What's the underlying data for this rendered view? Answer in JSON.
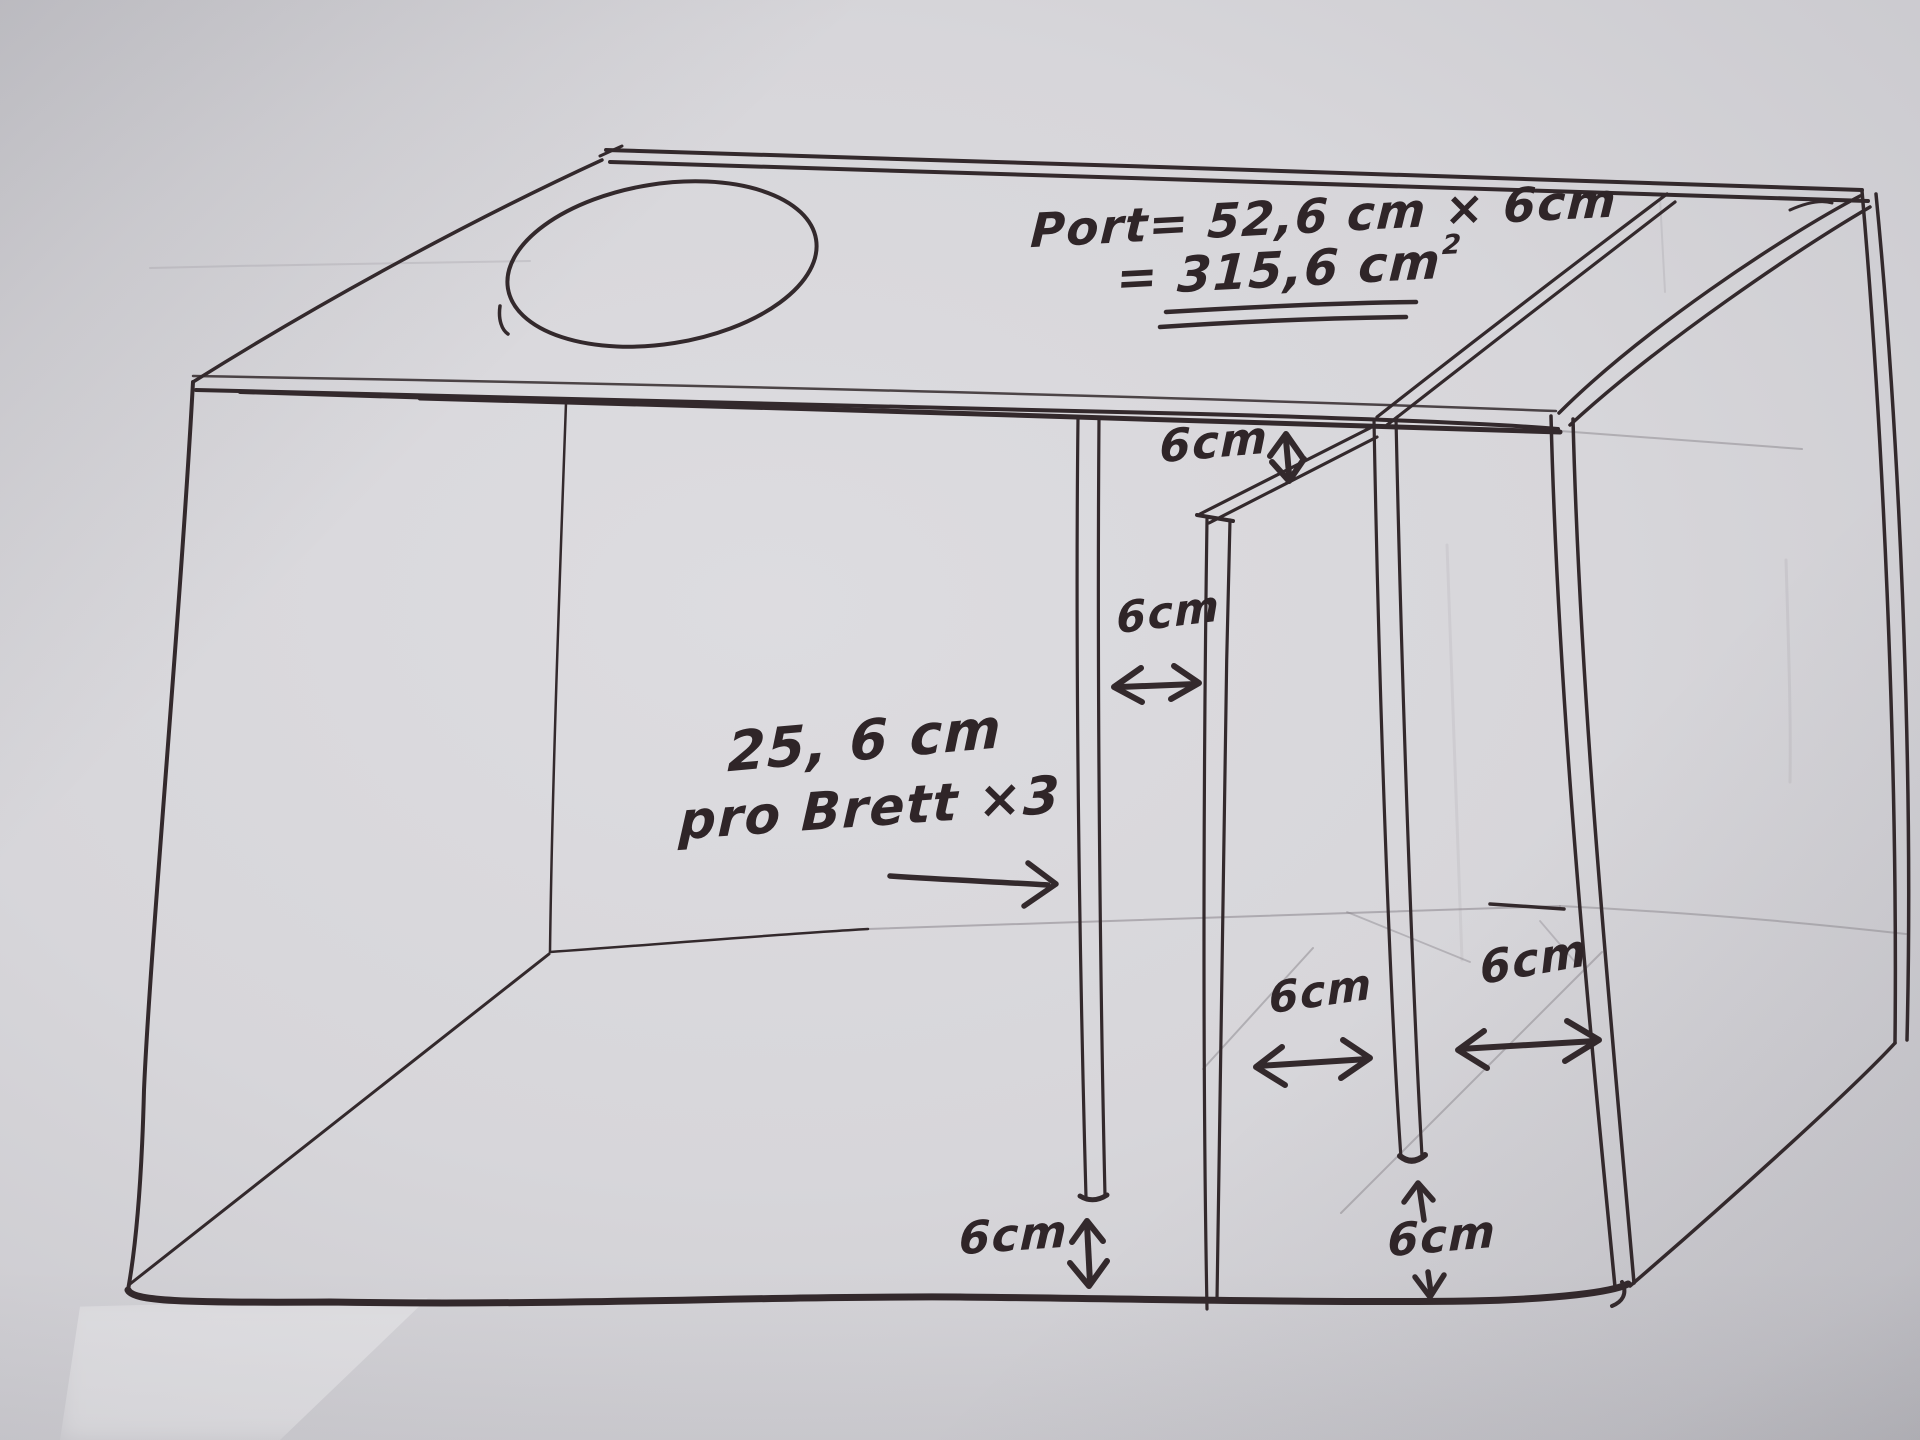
{
  "title": "Hand-drawn loudspeaker box sketch with port dimensions",
  "paper": {
    "background": "#d7d6da",
    "ink": "#33292c",
    "pencil": "#8a858c",
    "text_ink": "#2f2528"
  },
  "annotations": {
    "port_formula": {
      "line1": "Port= 52,6 cm × 6cm",
      "line2": "= 315,6 cm",
      "exponent": "2"
    },
    "slot_height": "6cm",
    "channel1_width": "6cm",
    "board_length": {
      "line1": "25, 6 cm",
      "line2": "pro Brett ×3"
    },
    "channel2_width": "6cm",
    "channel3_width": "6cm",
    "board1_bottom_gap": "6cm",
    "board3_bottom_gap": "6cm"
  }
}
